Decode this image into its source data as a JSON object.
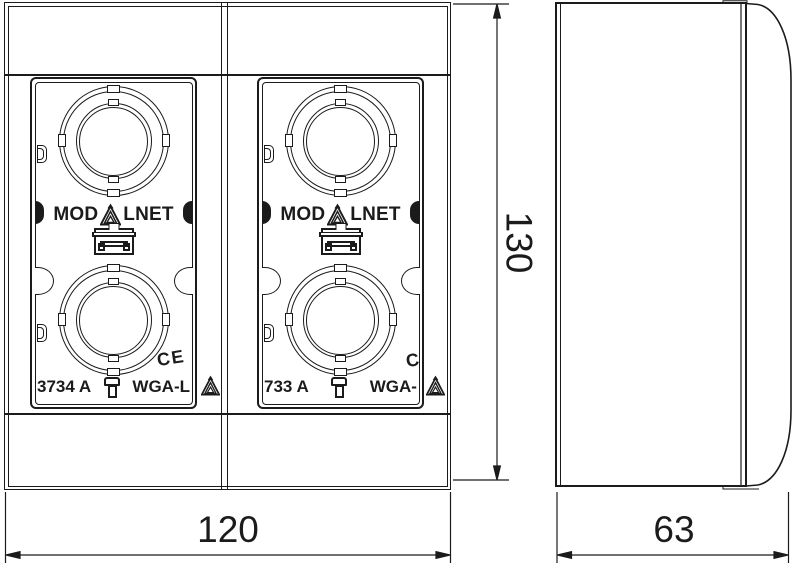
{
  "drawing": {
    "brand": {
      "left": "MOD",
      "right": "LNET"
    },
    "modules": [
      {
        "part_number": "3734 A",
        "model": "WGA-L",
        "ce_mark": "CE"
      },
      {
        "part_number": "733 A",
        "model": "WGA-",
        "ce_mark": "C"
      }
    ],
    "dimensions": {
      "height": "130",
      "width": "120",
      "depth": "63"
    },
    "icons": {
      "triangle-logo-icon": "nested-triangle-A with arrow tip",
      "clip-icon": "mounting-clip / padlock shape",
      "ce-mark": "CE conformity mark",
      "dimension-arrows": "filled slender arrowheads"
    }
  }
}
